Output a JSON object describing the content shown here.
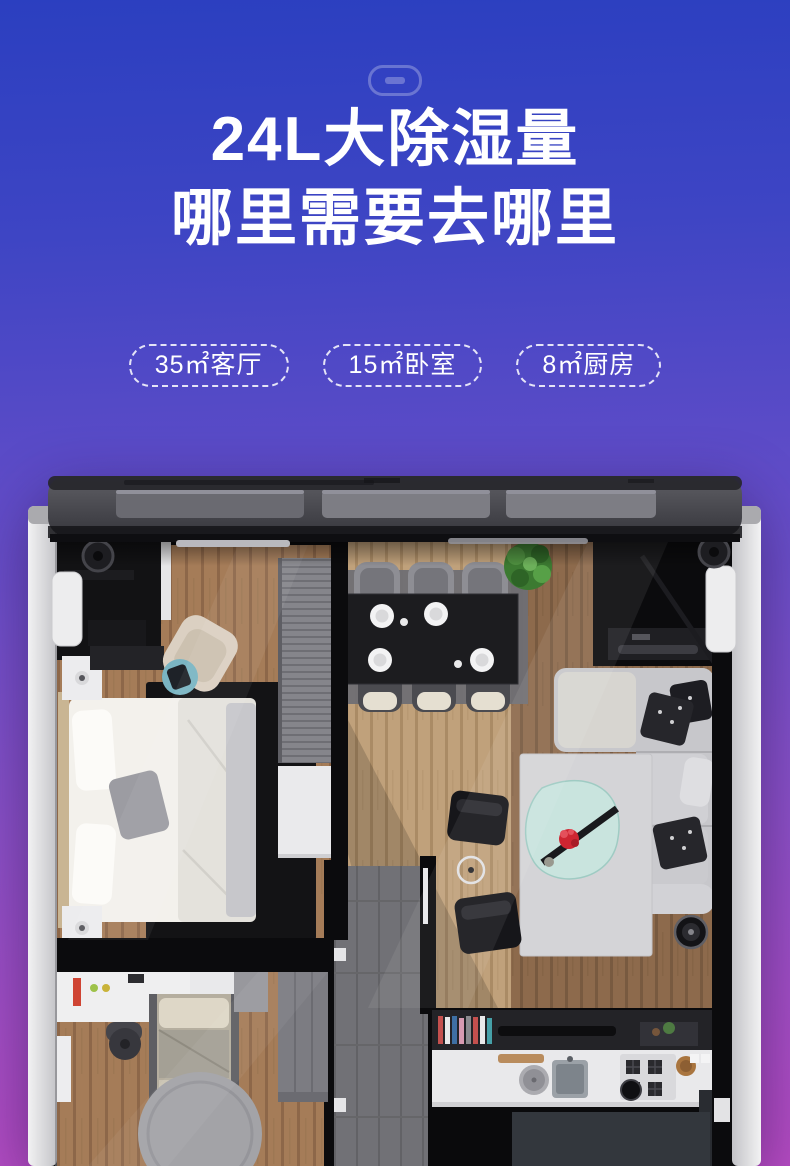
{
  "theme": {
    "background_top": "#2b3fc0",
    "background_bottom": "#b54bc2",
    "text_color": "#ffffff"
  },
  "header": {
    "device_icon": "dehumidifier-outline-icon",
    "title_line1": "24L大除湿量",
    "title_line2": "哪里需要去哪里"
  },
  "badges": [
    {
      "label": "35㎡客厅"
    },
    {
      "label": "15㎡卧室"
    },
    {
      "label": "8㎡厨房"
    }
  ],
  "floorplan": {
    "alt": "俯视3D户型图：主卧、餐厅、客厅、儿童房、厨房呈现在除湿机机身剖面内"
  }
}
